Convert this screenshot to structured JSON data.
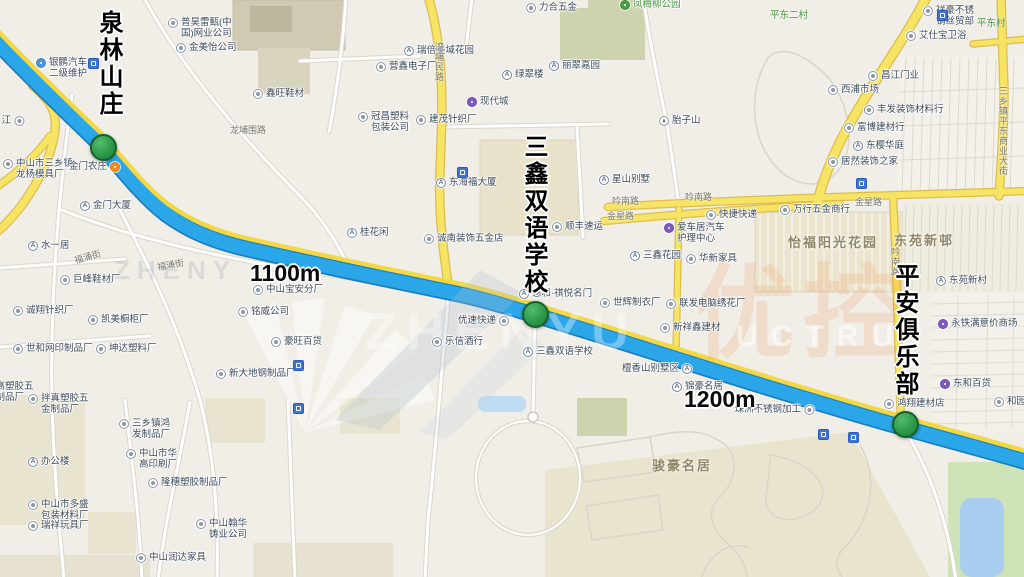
{
  "map": {
    "colors": {
      "route": "#2ba6e8",
      "route_casing": "#1a7fc0",
      "route_stripe": "#f2d845",
      "road_yellow": "#f7e464",
      "road_yellow_edge": "#dcbd4e",
      "marker_green": "#2c9a4b",
      "marker_edge": "#15602b",
      "water": "#a9cdee",
      "park": "#cfe3b8",
      "background": "#f1eee7"
    },
    "big_labels": [
      {
        "name": "annotation-quanlin-resort",
        "text": "泉林山庄",
        "x": 96,
        "y": 10
      },
      {
        "name": "annotation-sanxin-school",
        "text": "三鑫双语学校",
        "x": 521,
        "y": 134
      },
      {
        "name": "annotation-pingan-club",
        "text": "平安俱乐部",
        "x": 892,
        "y": 263
      }
    ],
    "distance_labels": [
      {
        "text": "1100m",
        "x": 250,
        "y": 260
      },
      {
        "text": "1200m",
        "x": 684,
        "y": 386
      }
    ],
    "markers": [
      {
        "name": "marker-quanlin-resort",
        "x": 103,
        "y": 147
      },
      {
        "name": "marker-sanxin-school",
        "x": 535,
        "y": 314
      },
      {
        "name": "marker-pingan-club",
        "x": 905,
        "y": 424
      }
    ],
    "area_labels": [
      {
        "text": "怡福阳光花园",
        "x": 788,
        "y": 232
      },
      {
        "text": "东苑新邨",
        "x": 894,
        "y": 230
      },
      {
        "text": "骏豪名居",
        "x": 652,
        "y": 455
      }
    ],
    "green_labels": [
      {
        "text": "平东二村",
        "x": 770,
        "y": 7
      },
      {
        "text": "平东村",
        "x": 977,
        "y": 15
      }
    ],
    "road_labels": [
      {
        "text": "龙埔围路",
        "x": 230,
        "y": 123
      },
      {
        "text": "福涌街",
        "x": 74,
        "y": 250,
        "rot": -16
      },
      {
        "text": "福涌街",
        "x": 157,
        "y": 258,
        "rot": -10
      },
      {
        "text": "吟南路",
        "x": 612,
        "y": 194
      },
      {
        "text": "吟南路",
        "x": 685,
        "y": 190
      },
      {
        "text": "金星路",
        "x": 607,
        "y": 209
      },
      {
        "text": "金星路",
        "x": 855,
        "y": 195
      },
      {
        "text": "湾埔民路",
        "x": 433,
        "y": 42,
        "vert": true
      },
      {
        "text": "吟南路",
        "x": 889,
        "y": 247,
        "vert": true
      },
      {
        "text": "三乡镇平东商业大街",
        "x": 997,
        "y": 86,
        "vert": true
      }
    ],
    "pois": [
      {
        "icon": "bus",
        "lines": [
          "银鹏汽车",
          "二级维护"
        ],
        "x": 36,
        "y": 62
      },
      {
        "icon": "poi",
        "lines": [
          "普昊雷甄(中",
          "国)网业公司"
        ],
        "x": 168,
        "y": 22
      },
      {
        "icon": "poi",
        "text": "金美怡公司",
        "x": 176,
        "y": 47
      },
      {
        "icon": "poi",
        "text": "鑫旺鞋材",
        "x": 253,
        "y": 93
      },
      {
        "icon": "poi",
        "lines": [
          "中山市三乡镇",
          "龙扬模具厂"
        ],
        "x": 3,
        "y": 163
      },
      {
        "icon": "orange",
        "text": "金门农庄",
        "x": 106,
        "y": 166,
        "side": "left"
      },
      {
        "icon": "bldg",
        "text": "金门大厦",
        "x": 80,
        "y": 205
      },
      {
        "icon": "bldg",
        "text": "水一居",
        "x": 28,
        "y": 245
      },
      {
        "icon": "poi",
        "text": "巨峰鞋材厂",
        "x": 60,
        "y": 279
      },
      {
        "icon": "poi",
        "text": "诚翔针织厂",
        "x": 13,
        "y": 310
      },
      {
        "icon": "poi",
        "text": "凯美橱柜厂",
        "x": 88,
        "y": 319
      },
      {
        "icon": "poi",
        "text": "世和网印制品厂",
        "x": 13,
        "y": 348
      },
      {
        "icon": "poi",
        "text": "坤达塑料厂",
        "x": 96,
        "y": 348
      },
      {
        "noicon": true,
        "lines": [
          "特高塑胶五",
          "金制品厂"
        ],
        "x": -14,
        "y": 386
      },
      {
        "icon": "poi",
        "lines": [
          "拌真塑胶五",
          "金制品厂"
        ],
        "x": 28,
        "y": 398
      },
      {
        "icon": "bldg",
        "text": "办公楼",
        "x": 28,
        "y": 461
      },
      {
        "icon": "poi",
        "lines": [
          "中山市多盛",
          "包装材料厂"
        ],
        "x": 28,
        "y": 504
      },
      {
        "icon": "poi",
        "text": "瑞祥玩具厂",
        "x": 28,
        "y": 525
      },
      {
        "icon": "poi",
        "lines": [
          "三乡镇鸿",
          "发制品厂"
        ],
        "x": 119,
        "y": 423
      },
      {
        "icon": "poi",
        "lines": [
          "中山市华",
          "高印刷厂"
        ],
        "x": 126,
        "y": 453
      },
      {
        "icon": "poi",
        "text": "隆穗塑胶制品厂",
        "x": 148,
        "y": 482
      },
      {
        "icon": "poi",
        "lines": [
          "中山翰华",
          "铸业公司"
        ],
        "x": 196,
        "y": 523
      },
      {
        "icon": "poi",
        "text": "中山润达家具",
        "x": 136,
        "y": 557
      },
      {
        "icon": "poi",
        "text": "江",
        "x": 10,
        "y": 120,
        "side": "left"
      },
      {
        "icon": "poi",
        "text": "中山宝安分厂",
        "x": 253,
        "y": 289
      },
      {
        "icon": "poi",
        "text": "铭威公司",
        "x": 238,
        "y": 311
      },
      {
        "icon": "poi",
        "text": "豪旺百货",
        "x": 271,
        "y": 341
      },
      {
        "icon": "poi",
        "text": "新大地钢制品厂",
        "x": 216,
        "y": 373
      },
      {
        "icon": "poi",
        "text": "力合五金",
        "x": 526,
        "y": 7
      },
      {
        "icon": "bldg",
        "text": "瑞倍美域花园",
        "x": 404,
        "y": 50
      },
      {
        "icon": "poi",
        "text": "营鑫电子厂",
        "x": 376,
        "y": 66
      },
      {
        "icon": "bldg",
        "text": "绿翠楼",
        "x": 502,
        "y": 74
      },
      {
        "icon": "bldg",
        "text": "丽翠嘉园",
        "x": 549,
        "y": 65
      },
      {
        "icon": "mall",
        "text": "现代城",
        "x": 467,
        "y": 101
      },
      {
        "icon": "poi",
        "lines": [
          "冠昌塑料",
          "包装公司"
        ],
        "x": 358,
        "y": 116
      },
      {
        "icon": "poi",
        "text": "建茂针织厂",
        "x": 416,
        "y": 119
      },
      {
        "icon": "bldg",
        "text": "东海福大厦",
        "x": 436,
        "y": 182
      },
      {
        "icon": "tree",
        "text": "凤梅柳公园",
        "x": 620,
        "y": 4,
        "green": true
      },
      {
        "icon": "mtn",
        "text": "胎子山",
        "x": 659,
        "y": 120
      },
      {
        "icon": "poi",
        "lines": [
          "祥豪不锈",
          "钢丝贸部"
        ],
        "x": 923,
        "y": 10
      },
      {
        "icon": "poi",
        "text": "艾仕宝卫浴",
        "x": 906,
        "y": 35
      },
      {
        "icon": "poi",
        "text": "昌江门业",
        "x": 868,
        "y": 75
      },
      {
        "icon": "poi",
        "text": "西浦市场",
        "x": 828,
        "y": 89
      },
      {
        "icon": "poi",
        "text": "丰发装饰材料行",
        "x": 864,
        "y": 109
      },
      {
        "icon": "poi",
        "text": "富博建材行",
        "x": 844,
        "y": 127
      },
      {
        "icon": "bldg",
        "text": "东樱华庭",
        "x": 853,
        "y": 145
      },
      {
        "icon": "poi",
        "text": "居然装饰之家",
        "x": 828,
        "y": 161
      },
      {
        "icon": "bldg",
        "text": "桂花闲",
        "x": 347,
        "y": 232
      },
      {
        "icon": "poi",
        "text": "诚南装饰五金店",
        "x": 424,
        "y": 238
      },
      {
        "icon": "poi",
        "text": "顺丰速运",
        "x": 552,
        "y": 226
      },
      {
        "icon": "bldg",
        "text": "星山别墅",
        "x": 599,
        "y": 179
      },
      {
        "icon": "bldg",
        "text": "三鑫花园",
        "x": 630,
        "y": 255
      },
      {
        "icon": "poi",
        "text": "华新家具",
        "x": 686,
        "y": 258
      },
      {
        "icon": "mall",
        "lines": [
          "爱车居汽车",
          "护理中心"
        ],
        "x": 664,
        "y": 227
      },
      {
        "icon": "poi",
        "text": "快捷快递",
        "x": 706,
        "y": 214
      },
      {
        "icon": "poi",
        "text": "万行五金商行",
        "x": 780,
        "y": 209
      },
      {
        "icon": "bldg",
        "text": "惠和·祺悦名门",
        "x": 519,
        "y": 293
      },
      {
        "icon": "poi",
        "text": "优速快递",
        "x": 495,
        "y": 320,
        "side": "left"
      },
      {
        "icon": "poi",
        "text": "乐信酒行",
        "x": 432,
        "y": 341
      },
      {
        "icon": "bldg",
        "text": "三鑫双语学校",
        "x": 523,
        "y": 351
      },
      {
        "icon": "poi",
        "text": "世辉制衣厂",
        "x": 600,
        "y": 302
      },
      {
        "icon": "poi",
        "text": "联发电脑绣花厂",
        "x": 666,
        "y": 303
      },
      {
        "icon": "poi",
        "text": "新祥鑫建材",
        "x": 660,
        "y": 327
      },
      {
        "icon": "bldg",
        "text": "檀香山别墅区",
        "x": 678,
        "y": 368,
        "side": "left"
      },
      {
        "icon": "bldg",
        "text": "锦豪名居",
        "x": 672,
        "y": 386
      },
      {
        "icon": "poi",
        "text": "珠洲不锈钢加工",
        "x": 800,
        "y": 409,
        "side": "left"
      },
      {
        "icon": "poi",
        "text": "鸿翔建材店",
        "x": 884,
        "y": 403
      },
      {
        "icon": "bldg",
        "text": "东苑新村",
        "x": 936,
        "y": 280
      },
      {
        "icon": "mall",
        "text": "永铁满意价商场",
        "x": 938,
        "y": 323
      },
      {
        "icon": "mall",
        "text": "东和百货",
        "x": 940,
        "y": 383
      },
      {
        "icon": "poi",
        "text": "和园百货",
        "x": 994,
        "y": 401
      }
    ],
    "sign_icons": [
      {
        "x": 88,
        "y": 58
      },
      {
        "x": 457,
        "y": 167
      },
      {
        "x": 856,
        "y": 178
      },
      {
        "x": 937,
        "y": 10
      },
      {
        "x": 293,
        "y": 360
      },
      {
        "x": 293,
        "y": 403
      },
      {
        "x": 818,
        "y": 429
      },
      {
        "x": 848,
        "y": 432
      }
    ],
    "watermark": {
      "cn": "优控",
      "latin_large": "ZHENYU",
      "latin_small": "UCTRU",
      "latin_faint": "ZHENY"
    }
  }
}
